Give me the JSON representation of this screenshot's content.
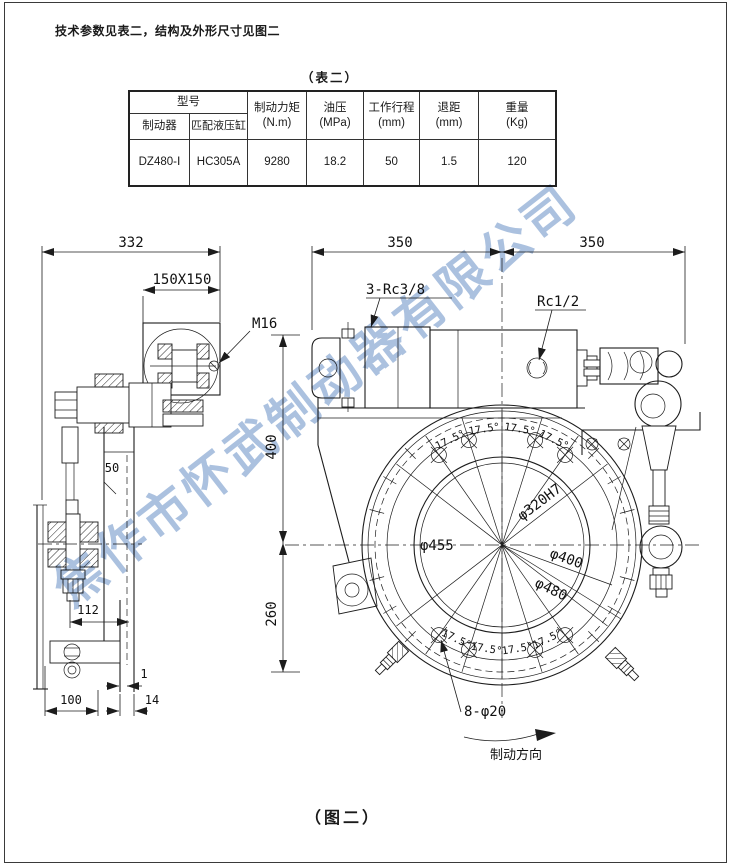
{
  "page": {
    "intro": "技术参数见表二，结构及外形尺寸见图二",
    "table_caption": "（表二）",
    "figure_caption": "（图二）",
    "watermark": "焦作市怀武制动器有限公司",
    "watermark_color": "#abc1df"
  },
  "table": {
    "model_header": "型号",
    "sub_headers": [
      "制动器",
      "匹配液压缸"
    ],
    "columns": [
      {
        "l1": "制动力矩",
        "l2": "(N.m)"
      },
      {
        "l1": "油压",
        "l2": "(MPa)"
      },
      {
        "l1": "工作行程",
        "l2": "(mm)"
      },
      {
        "l1": "退距",
        "l2": "(mm)"
      },
      {
        "l1": "重量",
        "l2": "(Kg)"
      }
    ],
    "row": [
      "DZ480-Ⅰ",
      "HC305A",
      "9280",
      "18.2",
      "50",
      "1.5",
      "120"
    ]
  },
  "drawing": {
    "d332": "332",
    "d150": "150X150",
    "m16": "M16",
    "d350a": "350",
    "d350b": "350",
    "rc38": "3-Rc3/8",
    "rc12": "Rc1/2",
    "d400": "400",
    "d260": "260",
    "d50": "50",
    "d112": "112",
    "d1": "1",
    "d100": "100",
    "d14": "14",
    "phi455": "φ455",
    "phi320": "φ320H7",
    "phi400": "φ400",
    "phi480": "φ480",
    "holes": "8-φ20",
    "angle": "17.5°",
    "direction": "制动方向"
  }
}
